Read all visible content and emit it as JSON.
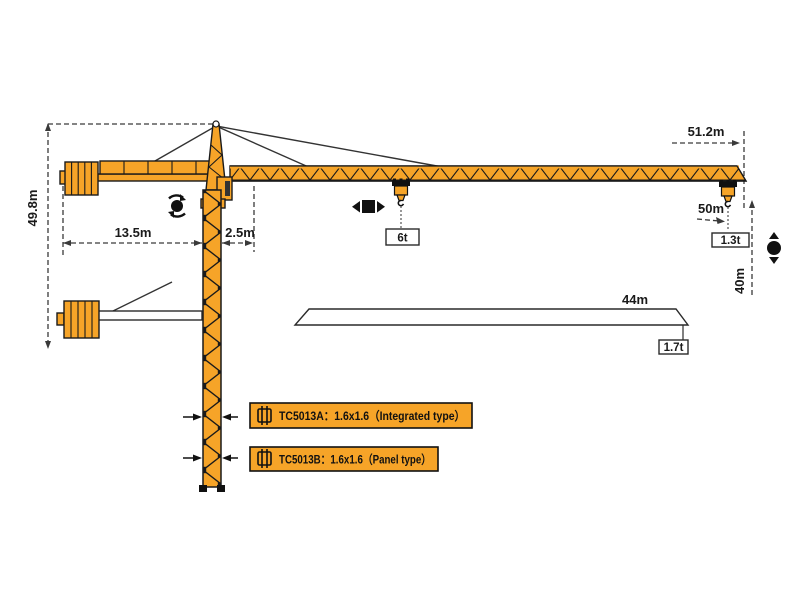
{
  "diagram": "tower-crane-working-range",
  "colors": {
    "crane_orange": "#F6A428",
    "outline": "#1A1A1A",
    "dimension_line": "#3A3A3A",
    "label_fill": "#F6A428"
  },
  "dimensions": {
    "tower_height": "49.8m",
    "counter_jib_radius": "13.5m",
    "center_offset": "2.5m",
    "working_radius": "51.2m",
    "hook_radius": "50m",
    "under_hook_height": "40m",
    "beam_length": "44m"
  },
  "loads": {
    "max_load": "6t",
    "tip_load": "1.3t",
    "beam_tip_load": "1.7t"
  },
  "models": {
    "a": "TC5013A：1.6x1.6（Integrated type）",
    "b": "TC5013B：1.6x1.6（Panel type）"
  }
}
